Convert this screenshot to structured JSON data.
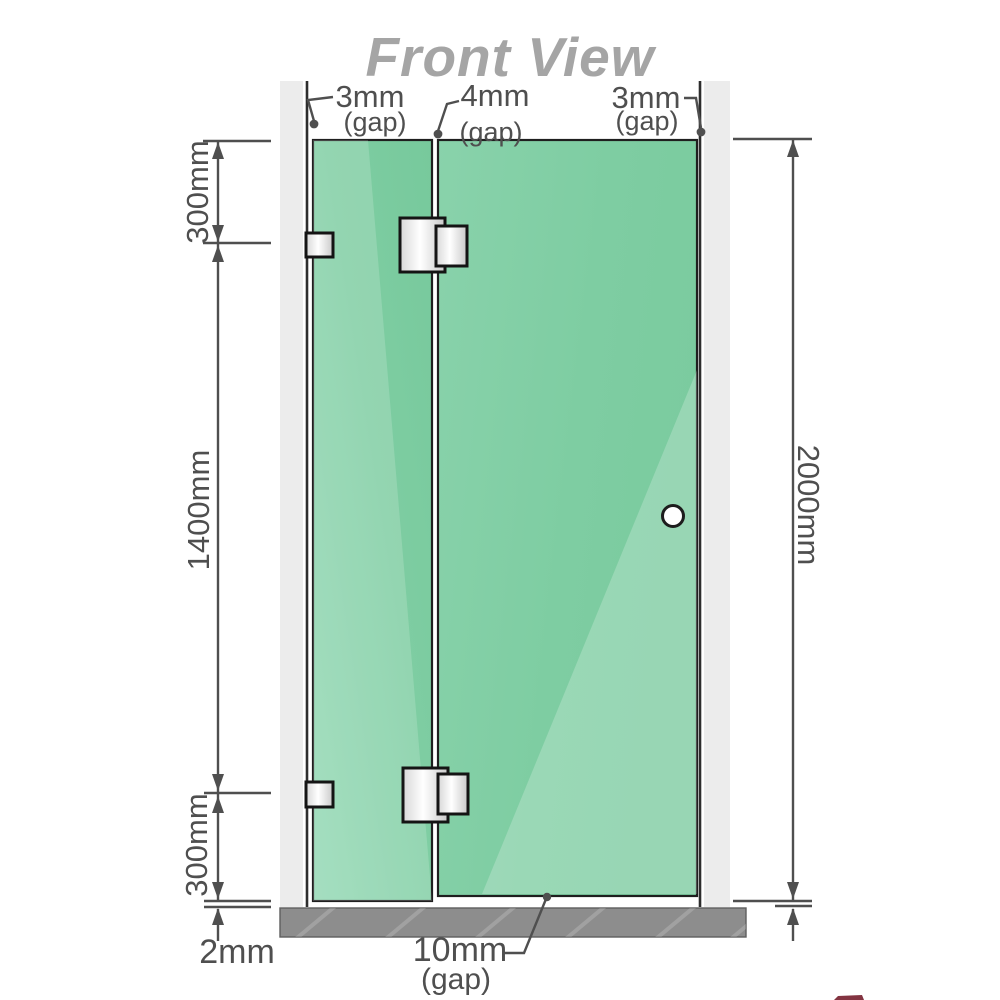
{
  "title": "Front View",
  "labels": {
    "gap_top_left": {
      "value": "3mm",
      "suffix": "(gap)"
    },
    "gap_top_middle": {
      "value": "4mm",
      "suffix": "(gap)"
    },
    "gap_top_right": {
      "value": "3mm",
      "suffix": "(gap)"
    },
    "dim_left_top": "300mm",
    "dim_left_middle": "1400mm",
    "dim_left_bottom": "300mm",
    "dim_floor_left": "2mm",
    "dim_right_height": "2000mm",
    "gap_bottom": {
      "value": "10mm",
      "suffix": "(gap)"
    }
  },
  "colors": {
    "glass": "#7ecda2",
    "glass_highlight": "#a9dfc3",
    "wall": "#ececec",
    "floor": "#8d8d8d",
    "dimension": "#4f4f4f",
    "title": "#a5a5a5",
    "hardware_stroke": "#141414"
  }
}
